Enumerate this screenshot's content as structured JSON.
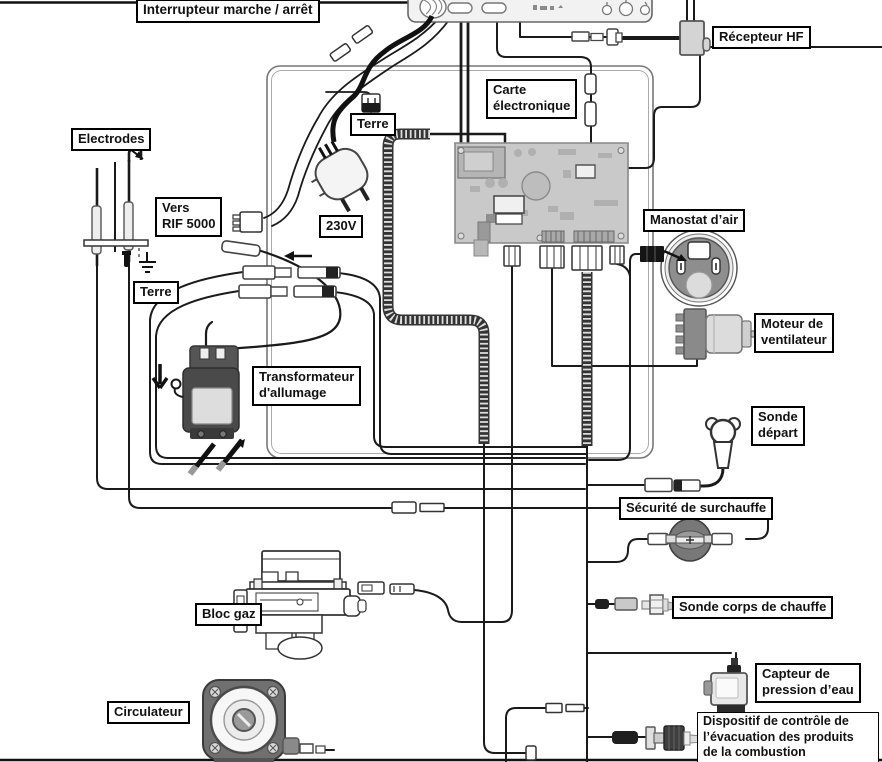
{
  "diagram": {
    "type": "boiler-wiring-diagram",
    "language": "fr",
    "labels": {
      "interrupteur": "Interrupteur marche / arrêt",
      "recepteur_hf": "Récepteur HF",
      "carte_electronique": "Carte\nélectronique",
      "terre_haut": "Terre",
      "electrodes": "Electrodes",
      "vers_rif": "Vers\nRIF 5000",
      "tension": "230V",
      "manostat": "Manostat d’air",
      "terre_bas": "Terre",
      "moteur_ventilateur": "Moteur de\nventilateur",
      "transformateur": "Transformateur\nd'allumage",
      "sonde_depart": "Sonde\ndépart",
      "securite_surchauffe": "Sécurité de surchauffe",
      "bloc_gaz": "Bloc gaz",
      "sonde_corps": "Sonde corps de chauffe",
      "capteur_pression": "Capteur de\npression d’eau",
      "circulateur": "Circulateur",
      "dispositif": "Dispositif de contrôle de\nl’évacuation des produits\nde la combustion"
    },
    "colors": {
      "wire": "#1a1a1a",
      "pcb": "#c9c9c9",
      "panel": "#f2f2f2",
      "dark_component": "#4a4a4a",
      "label_border": "#000000"
    }
  }
}
